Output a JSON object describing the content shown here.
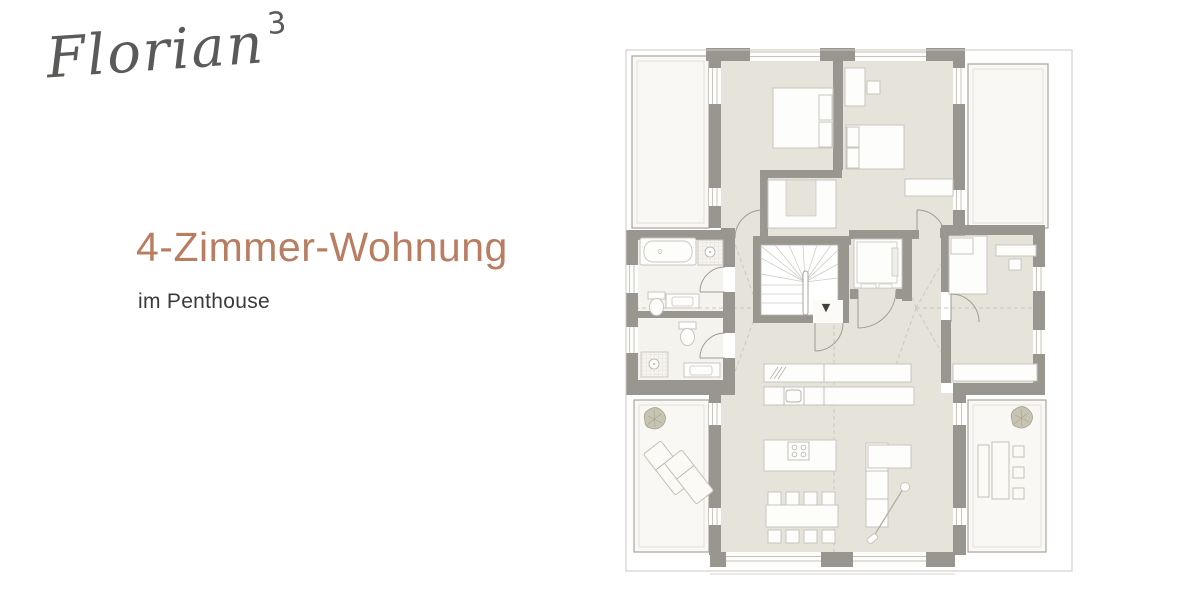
{
  "brand": {
    "logo_text": "Florian",
    "logo_superscript": "3"
  },
  "content": {
    "headline": "4-Zimmer-Wohnung",
    "subheadline": "im Penthouse"
  },
  "floor_plan": {
    "stairs_down_marker": "▼"
  },
  "colors": {
    "accent_headline": "#b97d61",
    "text_dark": "#3a3a39",
    "logo_gray": "#5a5a58",
    "wall_gray": "#98968e",
    "floor_beige": "#e6e3da",
    "terrace_white": "#f9f8f4"
  }
}
